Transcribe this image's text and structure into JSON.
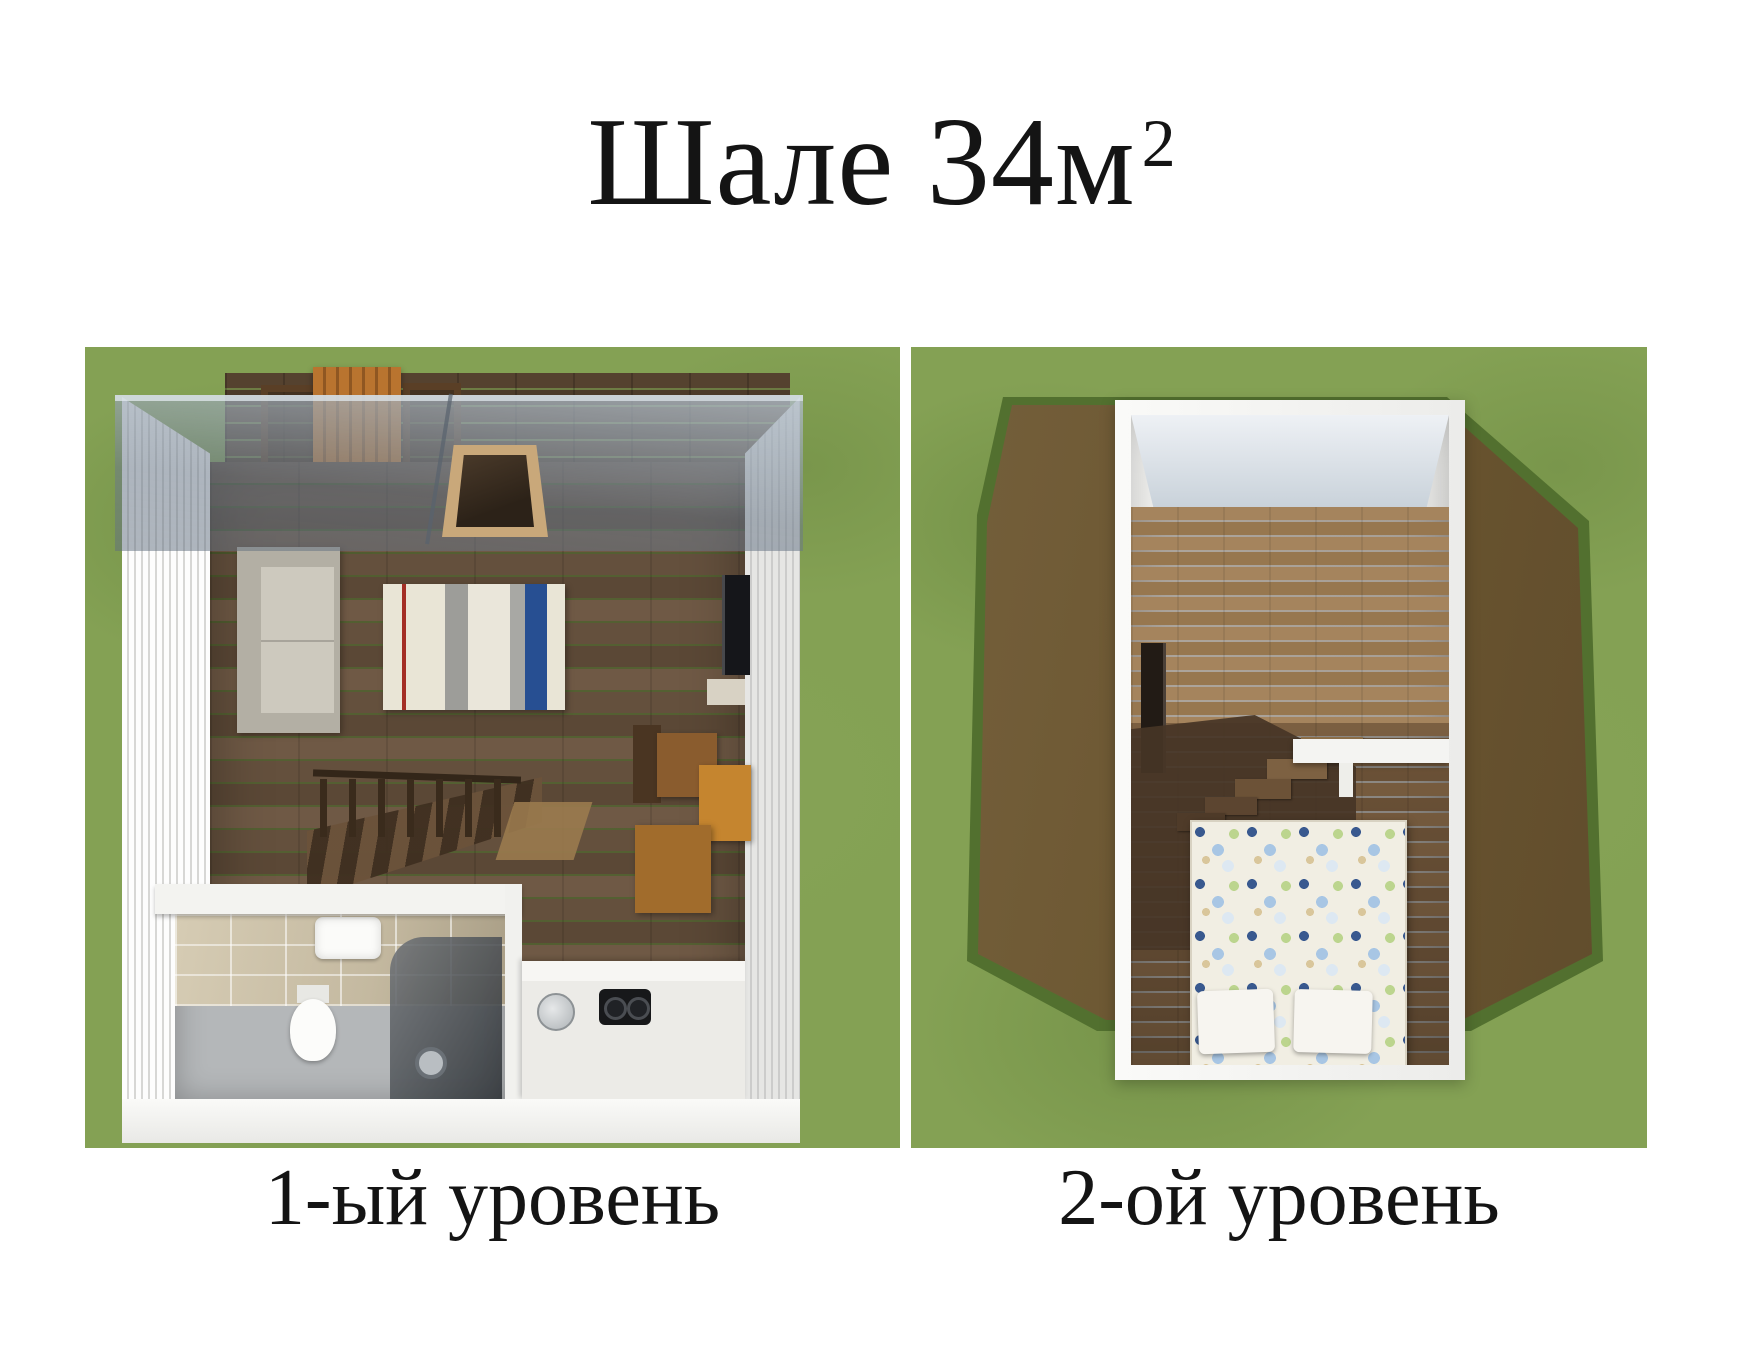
{
  "title": {
    "main": "Шале 34м",
    "sup": "2"
  },
  "panels": [
    {
      "id": "level-1",
      "caption": "1-ый уровень",
      "features": [
        "grass",
        "terrace-deck",
        "terrace-bench",
        "terrace-chairs",
        "glass-roof",
        "skylight-window",
        "sofa",
        "striped-rug-bed",
        "staircase",
        "tv",
        "media-shelf",
        "desk",
        "chair",
        "dining-table",
        "bathroom",
        "toilet",
        "sink",
        "shower",
        "kitchen-counter",
        "kitchen-sink",
        "stove"
      ]
    },
    {
      "id": "level-2",
      "caption": "2-ой уровень",
      "features": [
        "grass",
        "roof",
        "attic-room",
        "gable-ceiling",
        "wood-floor",
        "tv",
        "staircase-opening",
        "balustrade",
        "double-bed",
        "pillows"
      ]
    }
  ],
  "colors": {
    "grass": "#84a154",
    "roof": "#6c5533",
    "wall": "#f3f3f1",
    "floor_dark_wood": "#63503f",
    "floor_light_wood": "#9c7b55",
    "glass": "rgba(124,138,152,0.6)",
    "rug_blue": "#274f92",
    "rug_red": "#a32e25",
    "text": "#141414"
  }
}
